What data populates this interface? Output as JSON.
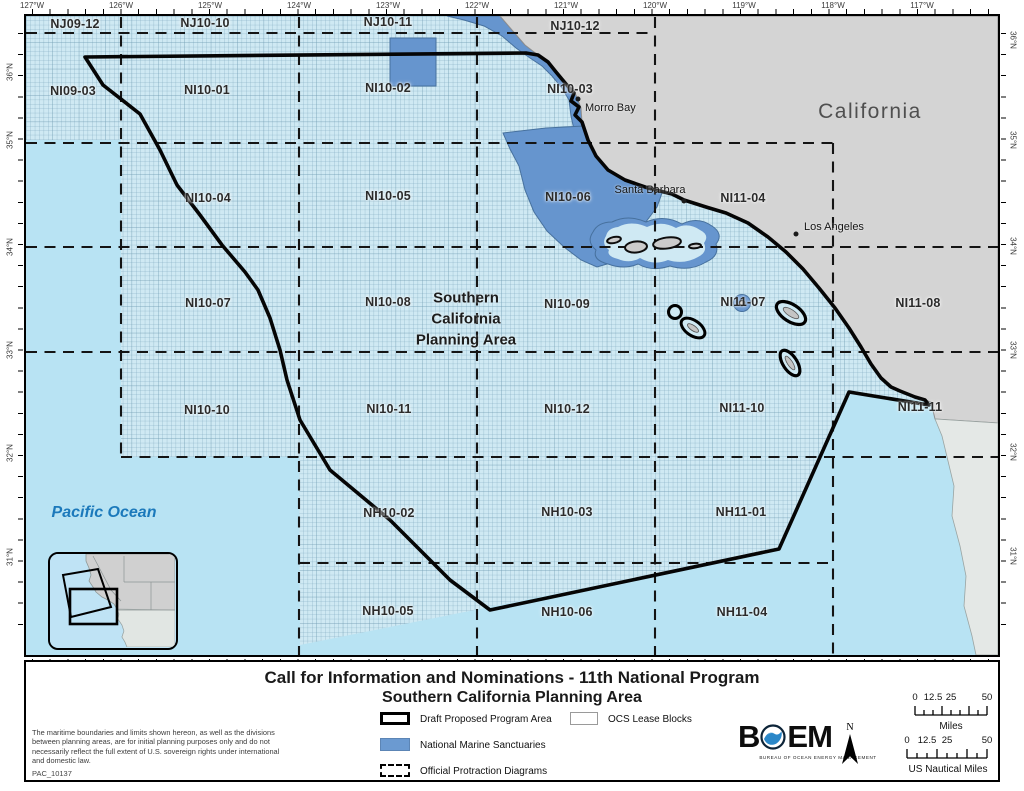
{
  "axes": {
    "longitude": [
      "127°W",
      "126°W",
      "125°W",
      "124°W",
      "123°W",
      "122°W",
      "121°W",
      "120°W",
      "119°W",
      "118°W",
      "117°W"
    ],
    "latitude_left": [
      "36°N",
      "35°N",
      "34°N",
      "33°N",
      "32°N",
      "31°N"
    ],
    "latitude_right": [
      "36°N",
      "35°N",
      "34°N",
      "33°N",
      "32°N",
      "31°N"
    ]
  },
  "map": {
    "protraction_labels": [
      "NJ09-12",
      "NJ10-10",
      "NJ10-11",
      "NJ10-12",
      "NI09-03",
      "NI10-01",
      "NI10-02",
      "NI10-03",
      "NI10-04",
      "NI10-05",
      "NI10-06",
      "NI11-04",
      "NI10-07",
      "NI10-08",
      "NI10-09",
      "NI11-07",
      "NI11-08",
      "NI10-10",
      "NI10-11",
      "NI10-12",
      "NI11-10",
      "NI11-11",
      "NH10-02",
      "NH10-03",
      "NH11-01",
      "NH10-05",
      "NH10-06",
      "NH11-04"
    ],
    "area_label_lines": {
      "l1": "Southern",
      "l2": "California",
      "l3": "Planning Area"
    },
    "state_label": "California",
    "ocean_label": "Pacific Ocean",
    "cities": {
      "morro_bay": "Morro Bay",
      "santa_barbara": "Santa Barbara",
      "los_angeles": "Los Angeles"
    }
  },
  "footer": {
    "title_line1": "Call for Information and Nominations - 11th National Program",
    "title_line2": "Southern California Planning Area",
    "disclaimer": "The maritime boundaries and limits shown hereon, as well as the divisions between planning areas, are for initial planning purposes only and do not necessarily reflect the full extent of U.S. sovereign rights under international and domestic law.",
    "map_id": "PAC_10137",
    "legend": {
      "draft": "Draft Proposed Program Area",
      "sanctuaries": "National Marine Sanctuaries",
      "protraction": "Official Protraction Diagrams",
      "lease_blocks": "OCS Lease Blocks"
    },
    "logo": {
      "b": "B",
      "em": "EM",
      "tagline": "BUREAU OF OCEAN ENERGY MANAGEMENT"
    },
    "north_label": "N",
    "scale_miles": {
      "t0": "0",
      "t1": "12.5",
      "t2": "25",
      "t3": "50",
      "unit": "Miles"
    },
    "scale_nm": {
      "t0": "0",
      "t1": "12.5",
      "t2": "25",
      "t3": "50",
      "unit": "US Nautical Miles"
    }
  },
  "colors": {
    "ocean": "#b8e3f3",
    "lease_grid_fill": "#cfe9f3",
    "land": "#d4d4d4",
    "sanctuary_blue": "#6695ce",
    "boundary_black": "#000000"
  }
}
